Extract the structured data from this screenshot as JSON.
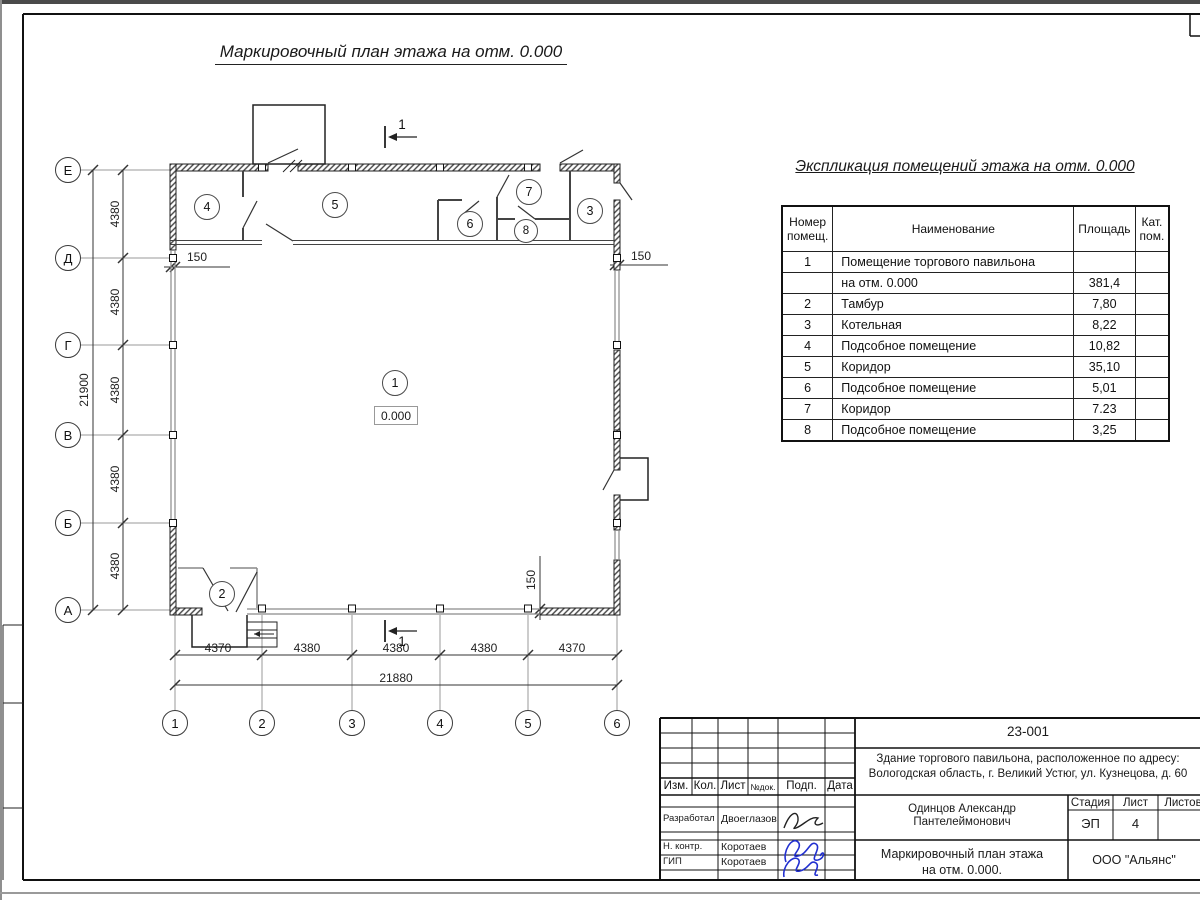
{
  "sheet": {
    "plan_title": "Маркировочный план этажа на отм. 0.000",
    "section_label": "1",
    "elevation_label": "0.000"
  },
  "axes": {
    "letters": [
      "Е",
      "Д",
      "Г",
      "В",
      "Б",
      "А"
    ],
    "numbers": [
      "1",
      "2",
      "3",
      "4",
      "5",
      "6"
    ]
  },
  "dimensions": {
    "left_segments": [
      "4380",
      "4380",
      "4380",
      "4380",
      "4380"
    ],
    "left_total": "21900",
    "bottom_segments": [
      "4370",
      "4380",
      "4380",
      "4380",
      "4370"
    ],
    "bottom_total": "21880",
    "wall_offset_left": "150",
    "wall_offset_right": "150",
    "wall_offset_bottom": "150"
  },
  "rooms": [
    "1",
    "2",
    "3",
    "4",
    "5",
    "6",
    "7",
    "8"
  ],
  "exposition": {
    "title": "Экспликация помещений этажа на отм. 0.000",
    "headers": [
      "Номер помещ.",
      "Наименование",
      "Площадь",
      "Кат. пом."
    ],
    "rows": [
      [
        "1",
        "Помещение торгового павильона",
        "",
        ""
      ],
      [
        "",
        "на отм. 0.000",
        "381,4",
        ""
      ],
      [
        "2",
        "Тамбур",
        "7,80",
        ""
      ],
      [
        "3",
        "Котельная",
        "8,22",
        ""
      ],
      [
        "4",
        "Подсобное помещение",
        "10,82",
        ""
      ],
      [
        "5",
        "Коридор",
        "35,10",
        ""
      ],
      [
        "6",
        "Подсобное помещение",
        "5,01",
        ""
      ],
      [
        "7",
        "Коридор",
        "7.23",
        ""
      ],
      [
        "8",
        "Подсобное помещение",
        "3,25",
        ""
      ]
    ]
  },
  "title_block": {
    "doc_number": "23-001",
    "address_line1": "Здание торгового павильона, расположенное по адресу:",
    "address_line2": "Вологодская область, г. Великий Устюг, ул. Кузнецова, д. 60",
    "columns": {
      "izm": "Изм.",
      "kol": "Кол.",
      "list": "Лист",
      "ndok": "№док.",
      "podp": "Подп.",
      "data": "Дата"
    },
    "roles": [
      {
        "role": "Разработал",
        "name": "Двоеглазов"
      },
      {
        "role": "Н. контр.",
        "name": "Коротаев"
      },
      {
        "role": "ГИП",
        "name": "Коротаев"
      }
    ],
    "person": "Одинцов Александр Пантелеймонович",
    "stage_label": "Стадия",
    "sheet_label": "Лист",
    "sheets_label": "Листов",
    "stage_value": "ЭП",
    "sheet_value": "4",
    "plan_name_line1": "Маркировочный план этажа",
    "plan_name_line2": "на отм. 0.000.",
    "company": "ООО \"Альянс\""
  }
}
